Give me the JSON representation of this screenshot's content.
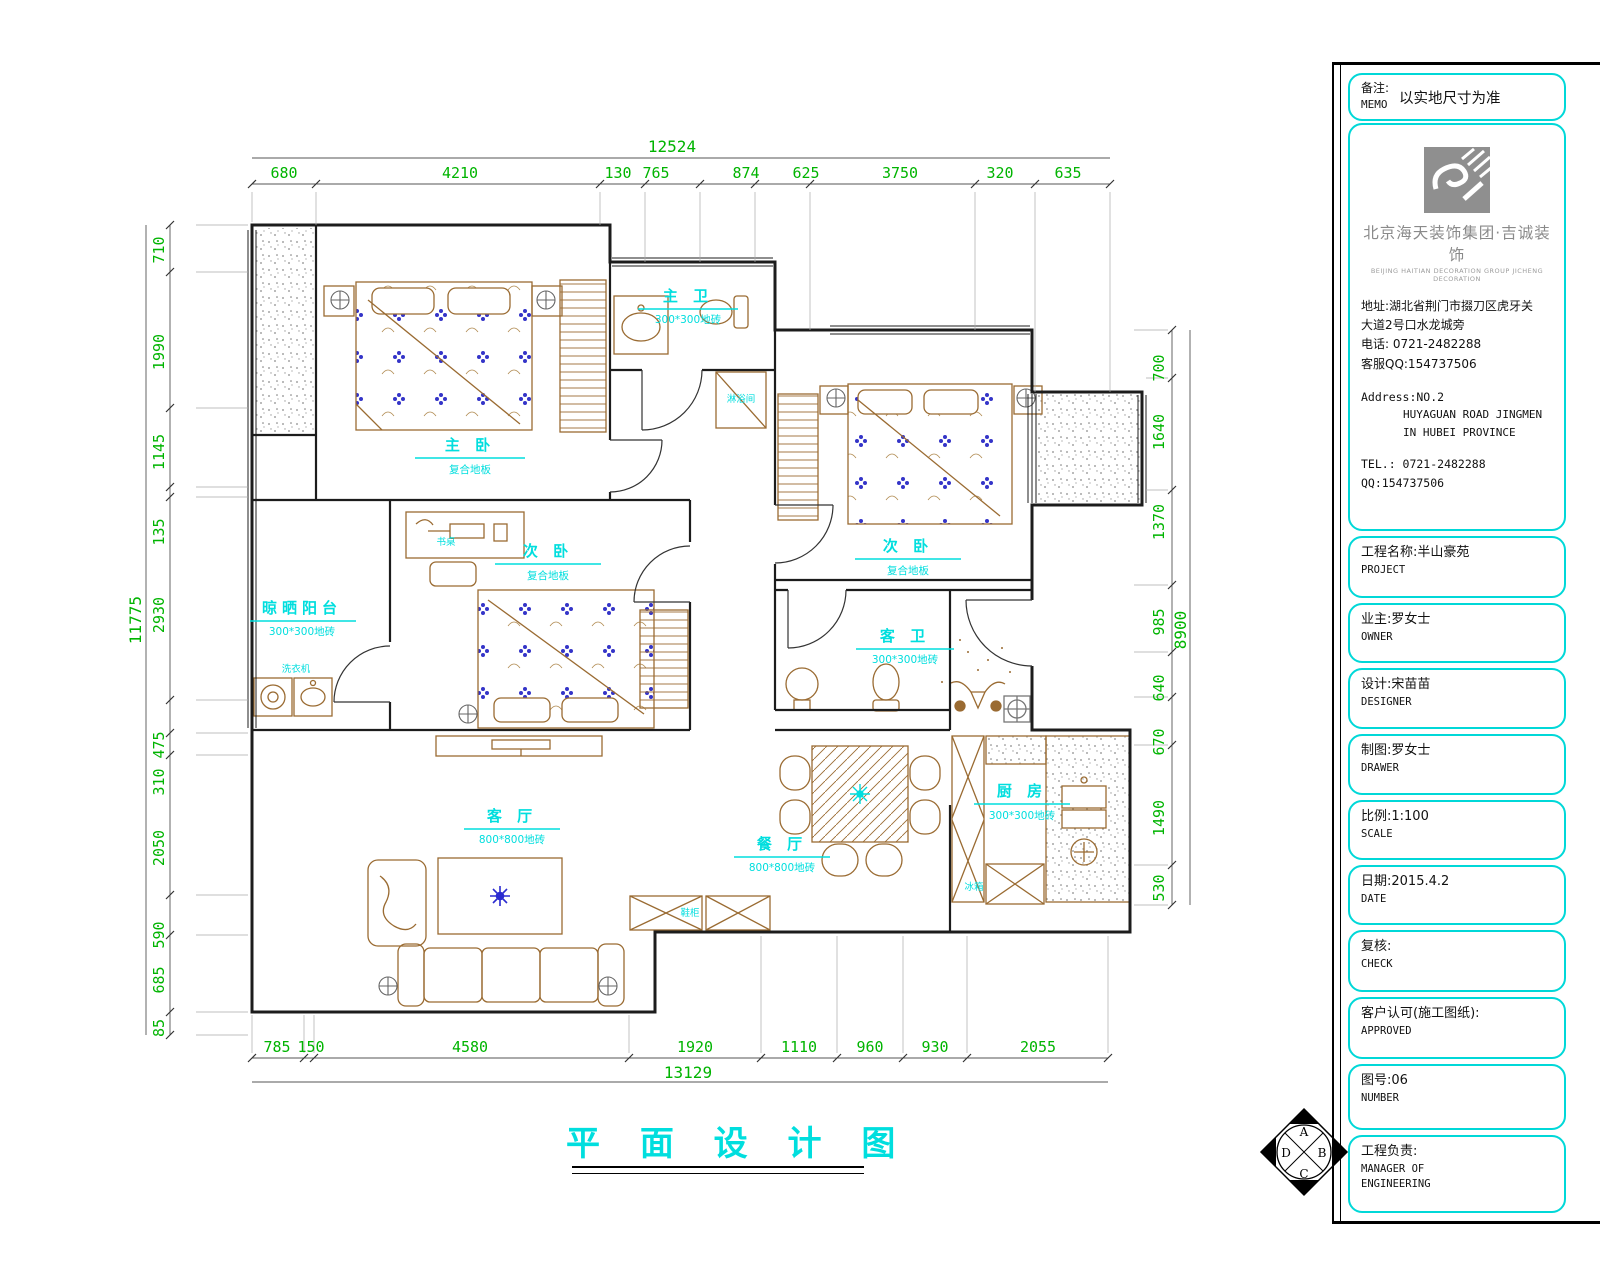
{
  "colors": {
    "dim_green": "#00b400",
    "label_cyan": "#00dede",
    "wall": "#1c1c1c",
    "furniture_tan": "#9a6b32",
    "accent_blue": "#2b2bd0",
    "box_cyan": "#00d8d8",
    "logo_gray": "#8f8f8f"
  },
  "plan": {
    "title": "平 面 设 计 图",
    "rooms": [
      {
        "label": "主 卧",
        "floor": "复合地板"
      },
      {
        "label": "次 卧",
        "floor": "复合地板"
      },
      {
        "label": "主 卫",
        "floor": "300*300地砖"
      },
      {
        "label": "客 卫",
        "floor": "300*300地砖"
      },
      {
        "label": "客 厅",
        "floor": "800*800地砖"
      },
      {
        "label": "餐 厅",
        "floor": "800*800地砖"
      },
      {
        "label": "厨 房",
        "floor": "300*300地砖"
      },
      {
        "label": "晾晒阳台",
        "floor": "300*300地砖"
      }
    ],
    "furniture": {
      "desk": "书桌",
      "shower": "淋浴间",
      "washer": "洗衣机",
      "shoe_cabinet": "鞋柜",
      "fridge": "冰箱"
    },
    "dims": {
      "top_total": "12524",
      "top": [
        "680",
        "4210",
        "130",
        "765",
        "874",
        "625",
        "3750",
        "320",
        "635"
      ],
      "left_total": "11775",
      "left": [
        "710",
        "1990",
        "1145",
        "135",
        "2930",
        "475",
        "310",
        "2050",
        "590",
        "685",
        "85"
      ],
      "right_total": "8900",
      "right": [
        "700",
        "1640",
        "1370",
        "985",
        "640",
        "670",
        "1490",
        "530"
      ],
      "bottom_total": "13129",
      "bottom": [
        "785",
        "150",
        "4580",
        "1920",
        "1110",
        "960",
        "930",
        "2055"
      ]
    }
  },
  "sidebar": {
    "memo": {
      "label_cn": "备注:",
      "label_en": "MEMO",
      "value": "以实地尺寸为准"
    },
    "company": {
      "name": "北京海天装饰集团·吉诚装饰",
      "name_en": "BEIJING HAITIAN DECORATION GROUP JICHENG DECORATION",
      "address_line1": "地址:湖北省荆门市掇刀区虎牙关",
      "address_line2": "大道2号口水龙城旁",
      "phone": "电话: 0721-2482288",
      "qq": "客服QQ:154737506",
      "address_en1": "Address:NO.2",
      "address_en2": "HUYAGUAN ROAD JINGMEN",
      "address_en3": "IN HUBEI PROVINCE",
      "tel_en": "TEL.: 0721-2482288",
      "qq_en": "QQ:154737506"
    },
    "fields": [
      {
        "cn": "工程名称:半山豪苑",
        "en": "PROJECT"
      },
      {
        "cn": "业主:罗女士",
        "en": "OWNER"
      },
      {
        "cn": "设计:宋苗苗",
        "en": "DESIGNER"
      },
      {
        "cn": "制图:罗女士",
        "en": "DRAWER"
      },
      {
        "cn": "比例:1:100",
        "en": "SCALE"
      },
      {
        "cn": "日期:2015.4.2",
        "en": "DATE"
      },
      {
        "cn": "复核:",
        "en": "CHECK"
      },
      {
        "cn": "客户认可(施工图纸):",
        "en": "APPROVED"
      },
      {
        "cn": "图号:06",
        "en": "NUMBER"
      },
      {
        "cn": "工程负责:",
        "en": "MANAGER OF",
        "en2": "ENGINEERING"
      }
    ],
    "compass": {
      "top": "A",
      "right": "B",
      "bottom": "C",
      "left": "D"
    }
  }
}
